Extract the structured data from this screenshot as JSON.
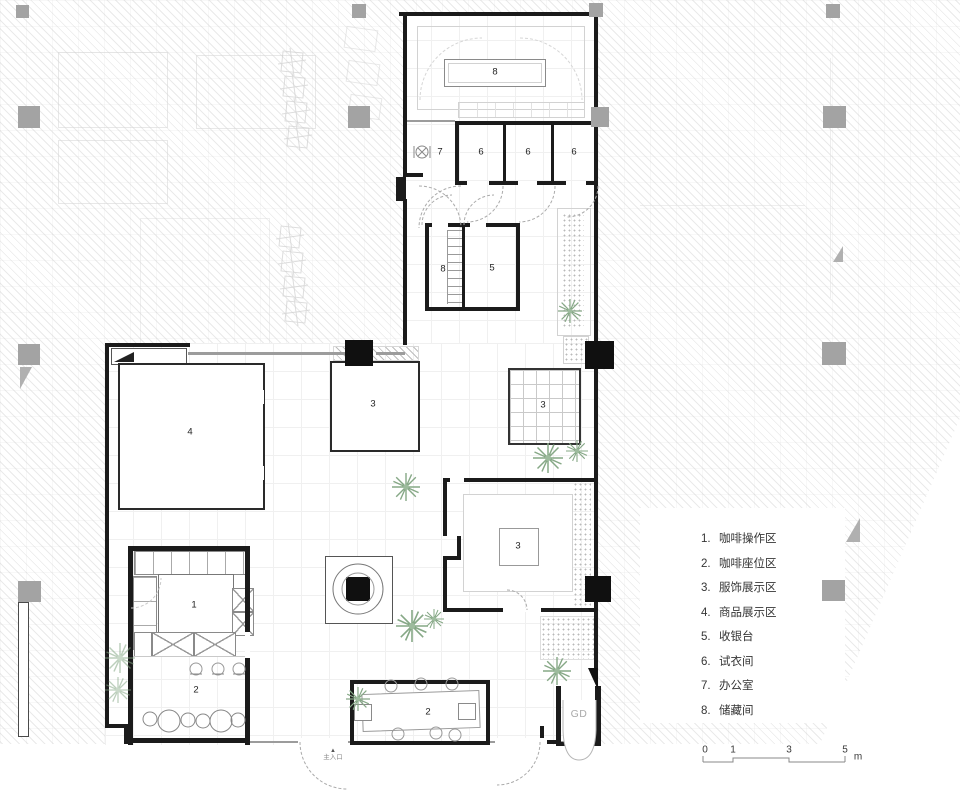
{
  "plan": {
    "room_labels": [
      {
        "id": "storage-top",
        "text": "8"
      },
      {
        "id": "office",
        "text": "7"
      },
      {
        "id": "fitting-1",
        "text": "6"
      },
      {
        "id": "fitting-2",
        "text": "6"
      },
      {
        "id": "fitting-3",
        "text": "6"
      },
      {
        "id": "storage-mid",
        "text": "8"
      },
      {
        "id": "cashier",
        "text": "5"
      },
      {
        "id": "goods-display",
        "text": "4"
      },
      {
        "id": "clothing-left",
        "text": "3"
      },
      {
        "id": "clothing-grid",
        "text": "3"
      },
      {
        "id": "clothing-bottom",
        "text": "3"
      },
      {
        "id": "coffee-bar",
        "text": "1"
      },
      {
        "id": "seating-left",
        "text": "2"
      },
      {
        "id": "seating-bottom",
        "text": "2"
      }
    ],
    "entrance_label": "主入口",
    "entrance_marker": "▲",
    "gd_label": "GD"
  },
  "legend": {
    "items": [
      {
        "num": "1.",
        "label": "咖啡操作区"
      },
      {
        "num": "2.",
        "label": "咖啡座位区"
      },
      {
        "num": "3.",
        "label": "服饰展示区"
      },
      {
        "num": "4.",
        "label": "商品展示区"
      },
      {
        "num": "5.",
        "label": "收银台"
      },
      {
        "num": "6.",
        "label": "试衣间"
      },
      {
        "num": "7.",
        "label": "办公室"
      },
      {
        "num": "8.",
        "label": "储藏间"
      }
    ]
  },
  "scale_bar": {
    "ticks": [
      "0",
      "1",
      "3",
      "5"
    ],
    "unit": "m"
  },
  "colors": {
    "wall": "#1b1b1b",
    "column_gray": "#a3a3a3",
    "column_black": "#101010",
    "plant_green": "#86a886",
    "hatch_gray": "#bdbdbd"
  }
}
